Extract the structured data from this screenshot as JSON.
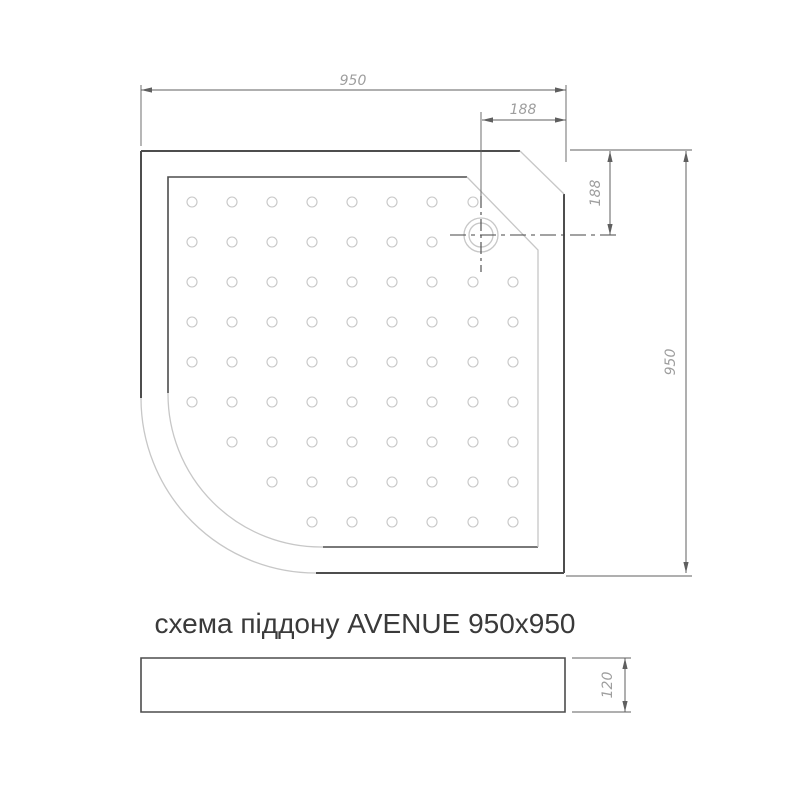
{
  "caption": {
    "text": "схема піддону AVENUE 950x950"
  },
  "dimensions": {
    "top_width": "950",
    "drain_offset_x": "188",
    "drain_offset_y": "188",
    "side_height": "950",
    "profile_height": "120"
  },
  "colors": {
    "background": "#ffffff",
    "line_dark": "#4d4d4d",
    "line_light": "#c7c7c7",
    "dim": "#5f5f5f",
    "dim_text": "#9e9e9e",
    "centerline": "#454545",
    "caption": "#3a3a3a"
  },
  "top_view": {
    "dots": {
      "radius": 5,
      "columns_x": [
        192,
        232,
        272,
        312,
        352,
        392,
        432,
        473,
        513
      ],
      "rows": [
        {
          "y": 202,
          "cols": [
            1,
            2,
            3,
            4,
            5,
            6,
            7,
            8
          ]
        },
        {
          "y": 242,
          "cols": [
            1,
            2,
            3,
            4,
            5,
            6,
            7
          ]
        },
        {
          "y": 282,
          "cols": [
            1,
            2,
            3,
            4,
            5,
            6,
            7,
            8,
            9
          ]
        },
        {
          "y": 322,
          "cols": [
            1,
            2,
            3,
            4,
            5,
            6,
            7,
            8,
            9
          ]
        },
        {
          "y": 362,
          "cols": [
            1,
            2,
            3,
            4,
            5,
            6,
            7,
            8,
            9
          ]
        },
        {
          "y": 402,
          "cols": [
            1,
            2,
            3,
            4,
            5,
            6,
            7,
            8,
            9
          ]
        },
        {
          "y": 442,
          "cols": [
            2,
            3,
            4,
            5,
            6,
            7,
            8,
            9
          ]
        },
        {
          "y": 482,
          "cols": [
            3,
            4,
            5,
            6,
            7,
            8,
            9
          ]
        },
        {
          "y": 522,
          "cols": [
            4,
            5,
            6,
            7,
            8,
            9
          ]
        }
      ]
    },
    "drain": {
      "cx": 481,
      "cy": 235,
      "radii": [
        17,
        12
      ]
    }
  }
}
